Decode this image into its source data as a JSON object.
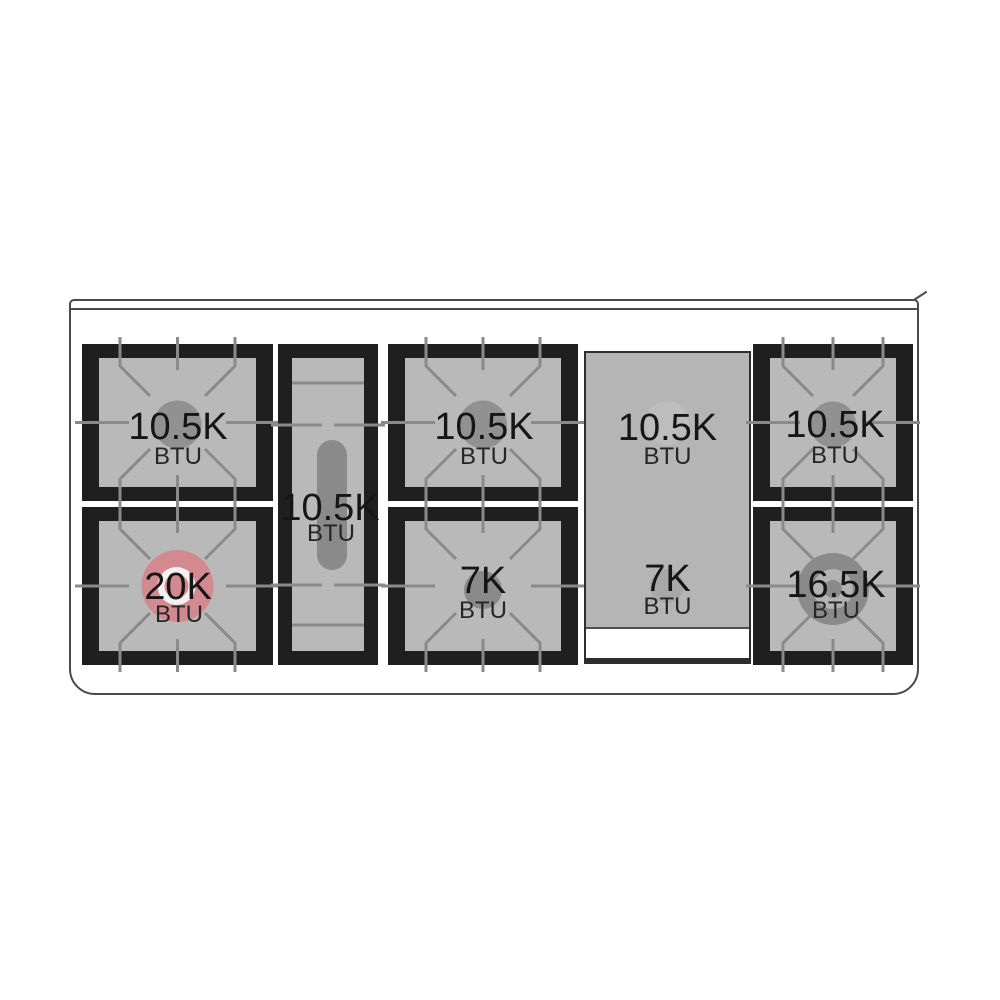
{
  "diagram": {
    "title": "range cooktop burner layout",
    "burners": {
      "left_rear": {
        "value": "10.5K",
        "unit": "BTU"
      },
      "left_front": {
        "value": "20K",
        "unit": "BTU"
      },
      "center_oval": {
        "value": "10.5K",
        "unit": "BTU"
      },
      "middle_rear": {
        "value": "10.5K",
        "unit": "BTU"
      },
      "middle_front": {
        "value": "7K",
        "unit": "BTU"
      },
      "griddle_rear": {
        "value": "10.5K",
        "unit": "BTU"
      },
      "griddle_front": {
        "value": "7K",
        "unit": "BTU"
      },
      "right_rear": {
        "value": "10.5K",
        "unit": "BTU"
      },
      "right_front": {
        "value": "16.5K",
        "unit": "BTU"
      }
    },
    "colors": {
      "grate_black": "#1f1f1f",
      "surface_gray": "#b9b9b9",
      "grate_line": "#8a8a8a",
      "burner_gray": "#919191",
      "burner_small_gray": "#8a8a8a",
      "burner_highlight_pink": "#d28a90",
      "burner_ring_white": "#f2f0f0",
      "griddle_gray": "#b5b5b5",
      "frame_line": "#4a4a4a",
      "background": "#ffffff"
    }
  }
}
